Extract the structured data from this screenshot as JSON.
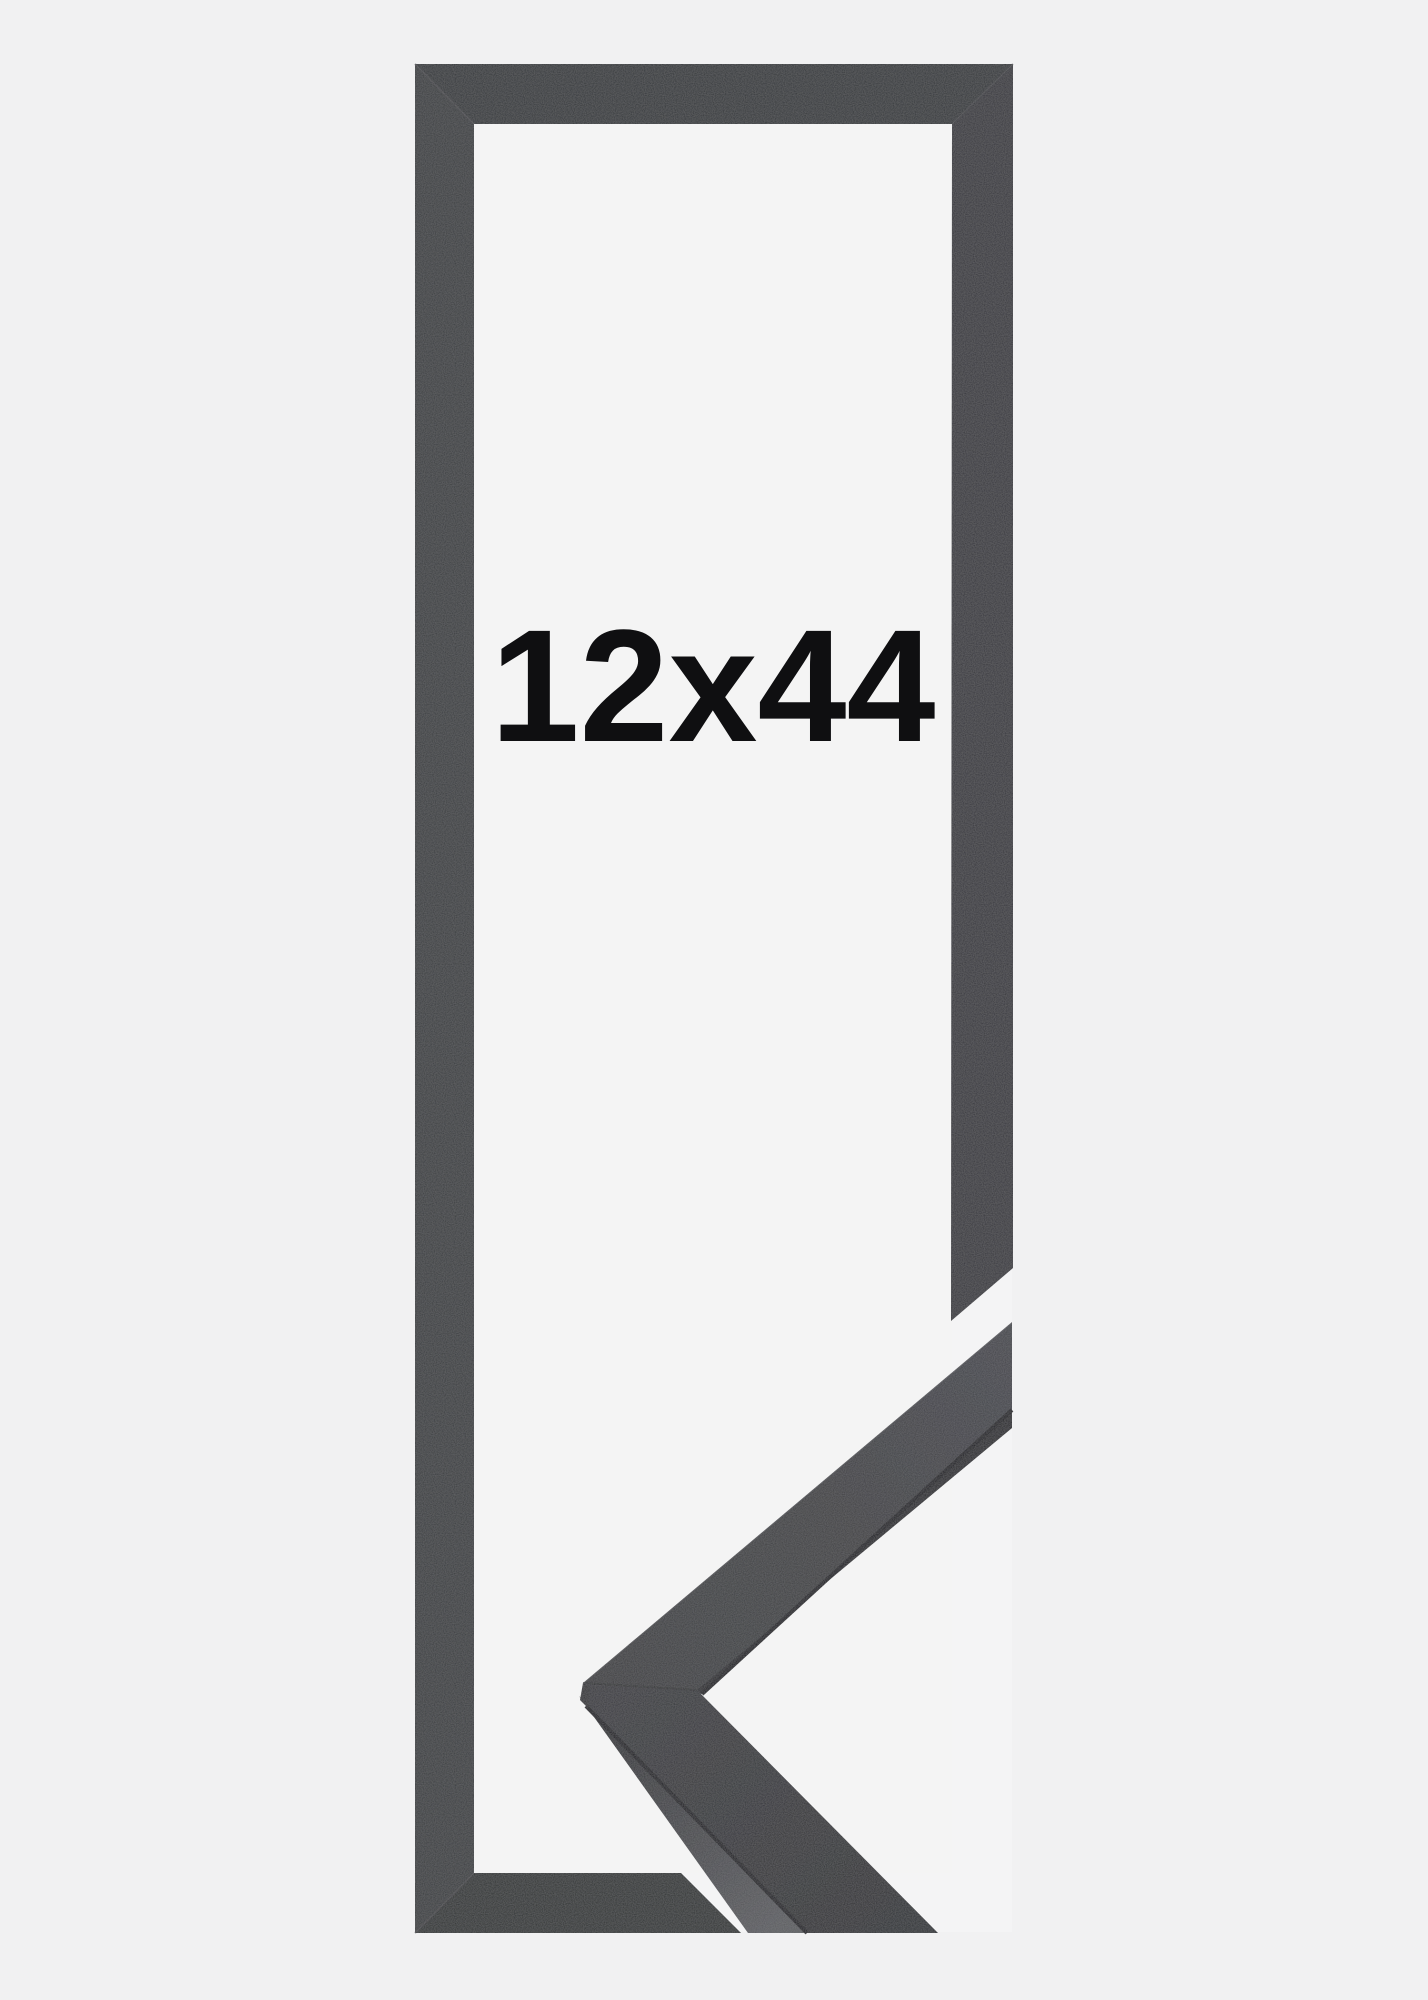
{
  "product_image": {
    "size_label": "12x44"
  },
  "colors": {
    "page_background": "#f1f1f2",
    "inner_background": "#f4f4f4",
    "photo_background": "#f4f4f5",
    "frame_bar_left": "#393a3d",
    "frame_bar_top": "#333439",
    "frame_bar_right": "#35363b",
    "frame_bar_bottom": "#2f3033",
    "sample_edge_dark": "#18191b",
    "label_text": "#0f0f11"
  }
}
